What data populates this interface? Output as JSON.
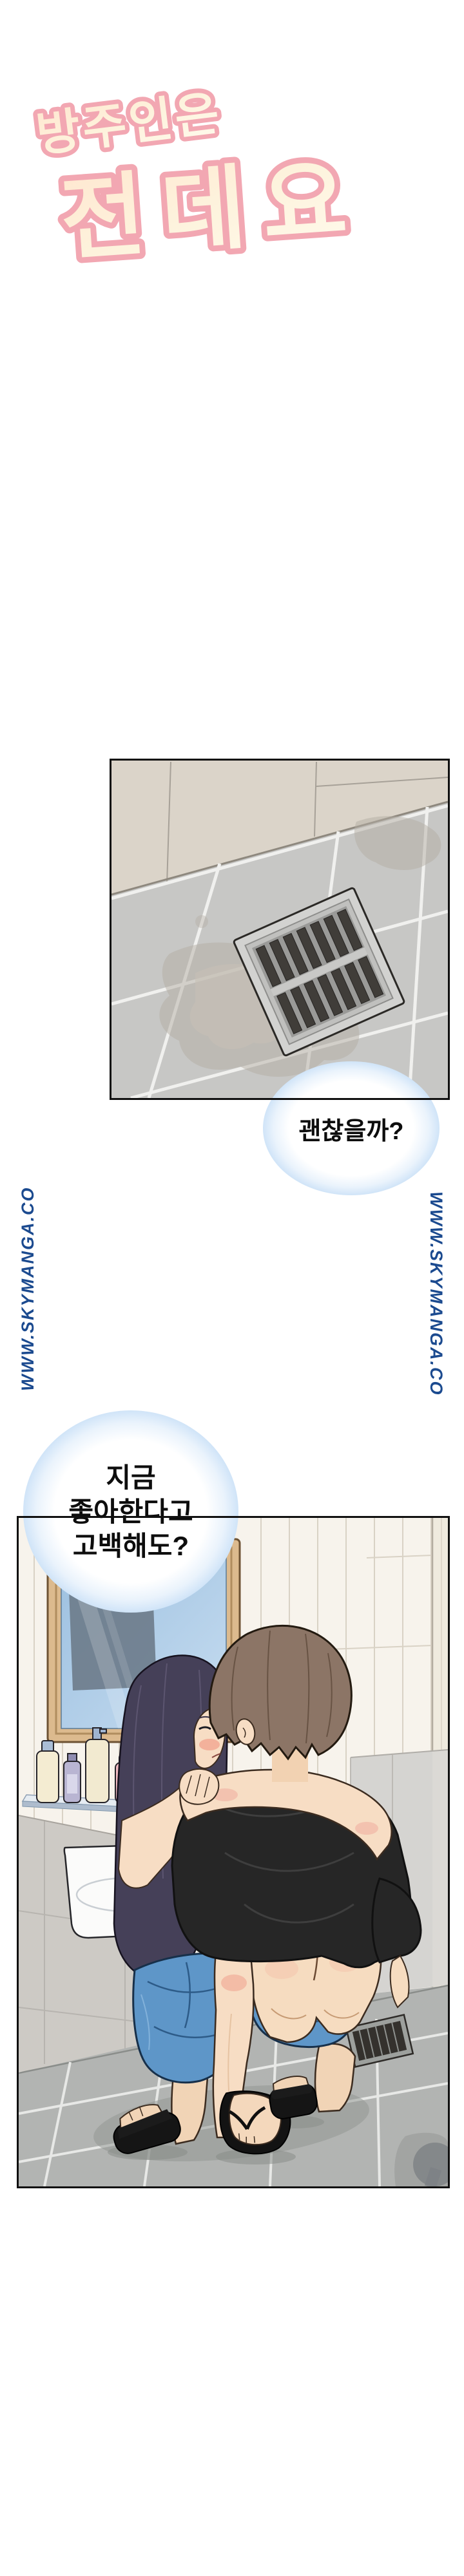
{
  "title": {
    "line1": "방주인은",
    "line2": "전데요"
  },
  "bubbles": {
    "b1": {
      "text": "괜찮을까?"
    },
    "b2": {
      "line1": "지금",
      "line2": "좋아한다고",
      "line3": "고백해도?"
    }
  },
  "watermarks": {
    "left": "WWW.SKYMANGA.CO",
    "right": "WWW.SKYMANGA.CO"
  },
  "colors": {
    "title_fill": "#fdf3dd",
    "title_outline": "#f2a7b2",
    "watermark_blue": "#1b4a8f",
    "bubble_glow_blue": "#c9e0f7",
    "panel_border": "#101010",
    "wall_beige": "#dbd4c9",
    "floor_grey": "#c7c7c5",
    "bathroom_tile_white": "#f7f3ec",
    "bathroom_wall_grey": "#cdcac5",
    "bathroom_floor_grey": "#b2b4b2",
    "mirror_frame_wood": "#dcba8e",
    "mirror_glass_blue": "#a9c9e6",
    "tee_black": "#262626",
    "shorts_blue": "#5e96c8",
    "hair_man_brown": "#8c7566",
    "hair_woman_dark": "#454058",
    "skin": "#f6dcc0"
  }
}
